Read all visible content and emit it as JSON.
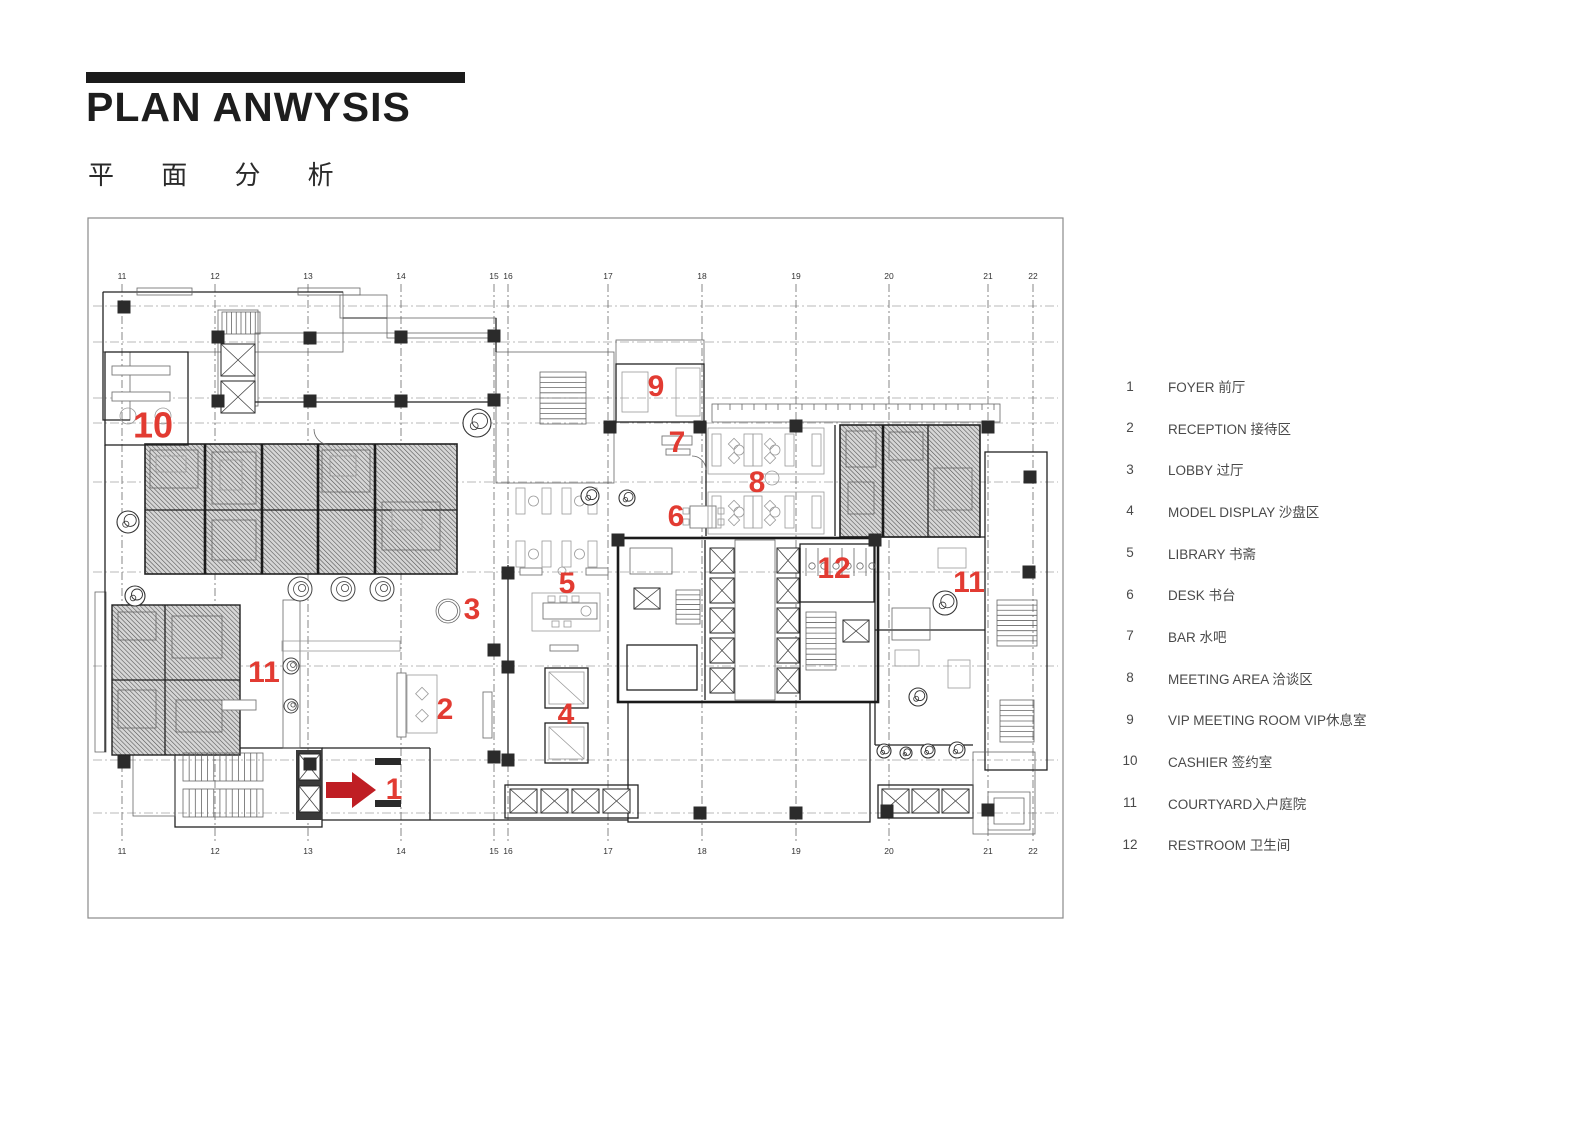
{
  "header": {
    "title": "PLAN ANWYSIS",
    "subtitle": "平 面 分 析"
  },
  "legend": {
    "items": [
      {
        "num": "1",
        "text": "FOYER 前厅"
      },
      {
        "num": "2",
        "text": "RECEPTION 接待区"
      },
      {
        "num": "3",
        "text": "LOBBY 过厅"
      },
      {
        "num": "4",
        "text": "MODEL DISPLAY 沙盘区"
      },
      {
        "num": "5",
        "text": "LIBRARY 书斋"
      },
      {
        "num": "6",
        "text": "DESK 书台"
      },
      {
        "num": "7",
        "text": "BAR 水吧"
      },
      {
        "num": "8",
        "text": "MEETING AREA 洽谈区"
      },
      {
        "num": "9",
        "text": "VIP MEETING ROOM VIP休息室"
      },
      {
        "num": "10",
        "text": "CASHIER 签约室"
      },
      {
        "num": "11",
        "text": "COURTYARD入户庭院"
      },
      {
        "num": "12",
        "text": "RESTROOM 卫生间"
      }
    ]
  },
  "plan": {
    "grid_columns": [
      {
        "label": "11",
        "x": 122
      },
      {
        "label": "12",
        "x": 215
      },
      {
        "label": "13",
        "x": 308
      },
      {
        "label": "14",
        "x": 401
      },
      {
        "label": "15",
        "x": 494
      },
      {
        "label": "16",
        "x": 508
      },
      {
        "label": "17",
        "x": 608
      },
      {
        "label": "18",
        "x": 702
      },
      {
        "label": "19",
        "x": 796
      },
      {
        "label": "20",
        "x": 889
      },
      {
        "label": "21",
        "x": 988
      },
      {
        "label": "22",
        "x": 1033
      }
    ],
    "markers": [
      {
        "label": "1",
        "x": 394,
        "y": 791
      },
      {
        "label": "2",
        "x": 445,
        "y": 711
      },
      {
        "label": "3",
        "x": 472,
        "y": 611
      },
      {
        "label": "4",
        "x": 566,
        "y": 716
      },
      {
        "label": "5",
        "x": 567,
        "y": 585
      },
      {
        "label": "6",
        "x": 676,
        "y": 518
      },
      {
        "label": "7",
        "x": 677,
        "y": 444
      },
      {
        "label": "8",
        "x": 757,
        "y": 484
      },
      {
        "label": "9",
        "x": 656,
        "y": 388
      },
      {
        "label": "10",
        "x": 153,
        "y": 428,
        "size": 36
      },
      {
        "label": "11",
        "x": 264,
        "y": 674
      },
      {
        "label": "11",
        "x": 969,
        "y": 584
      },
      {
        "label": "12",
        "x": 834,
        "y": 570
      }
    ],
    "entry_arrow": {
      "tail_x": 326,
      "tip_x": 376,
      "y": 790
    },
    "colors": {
      "marker_red": "#e23b32",
      "arrow_red": "#bf1e24"
    }
  }
}
